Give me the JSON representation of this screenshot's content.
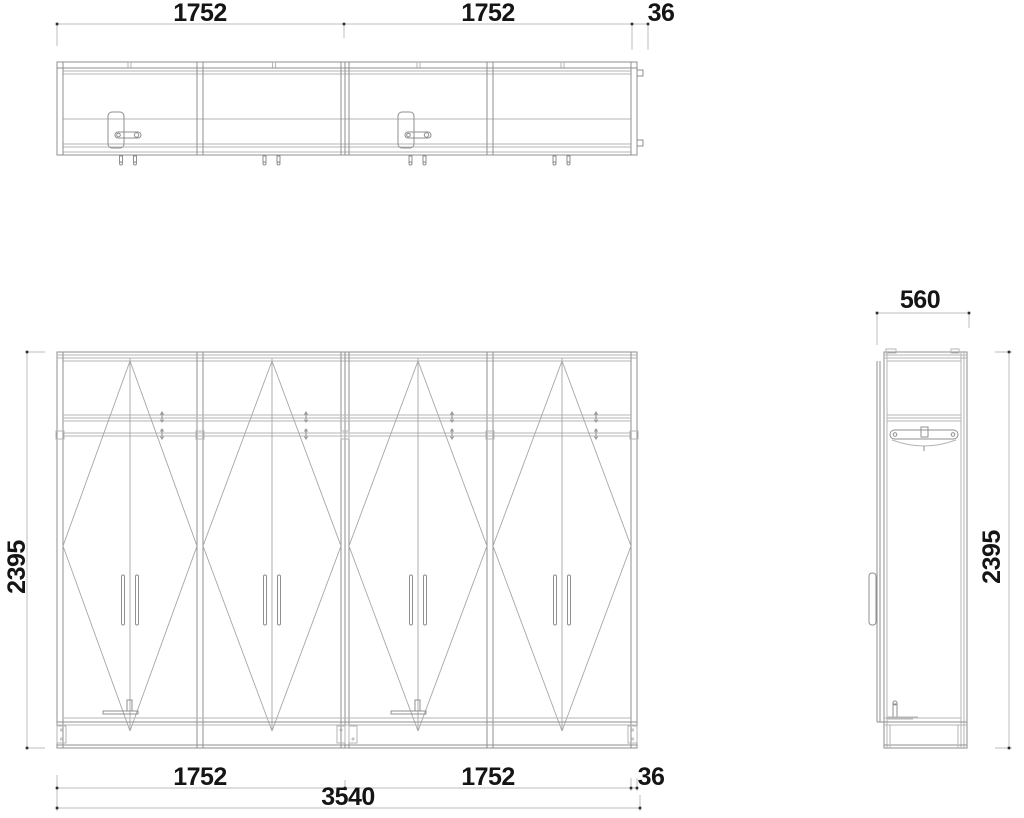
{
  "drawing": {
    "type": "wardrobe-technical-drawing",
    "views": {
      "plan": "top view",
      "front": "front elevation",
      "side": "side elevation"
    },
    "colors": {
      "background": "#ffffff",
      "line": "#8f8f8f",
      "light_line": "#b6b6b6",
      "dimension_line": "#bcbcbc",
      "text": "#151515"
    },
    "dims": {
      "top": {
        "left": "1752",
        "right": "1752",
        "offset": "36"
      },
      "bottom": {
        "left": "1752",
        "right": "1752",
        "offset": "36",
        "total": "3540"
      },
      "front_height": "2395",
      "side_width": "560",
      "side_height": "2395"
    }
  }
}
